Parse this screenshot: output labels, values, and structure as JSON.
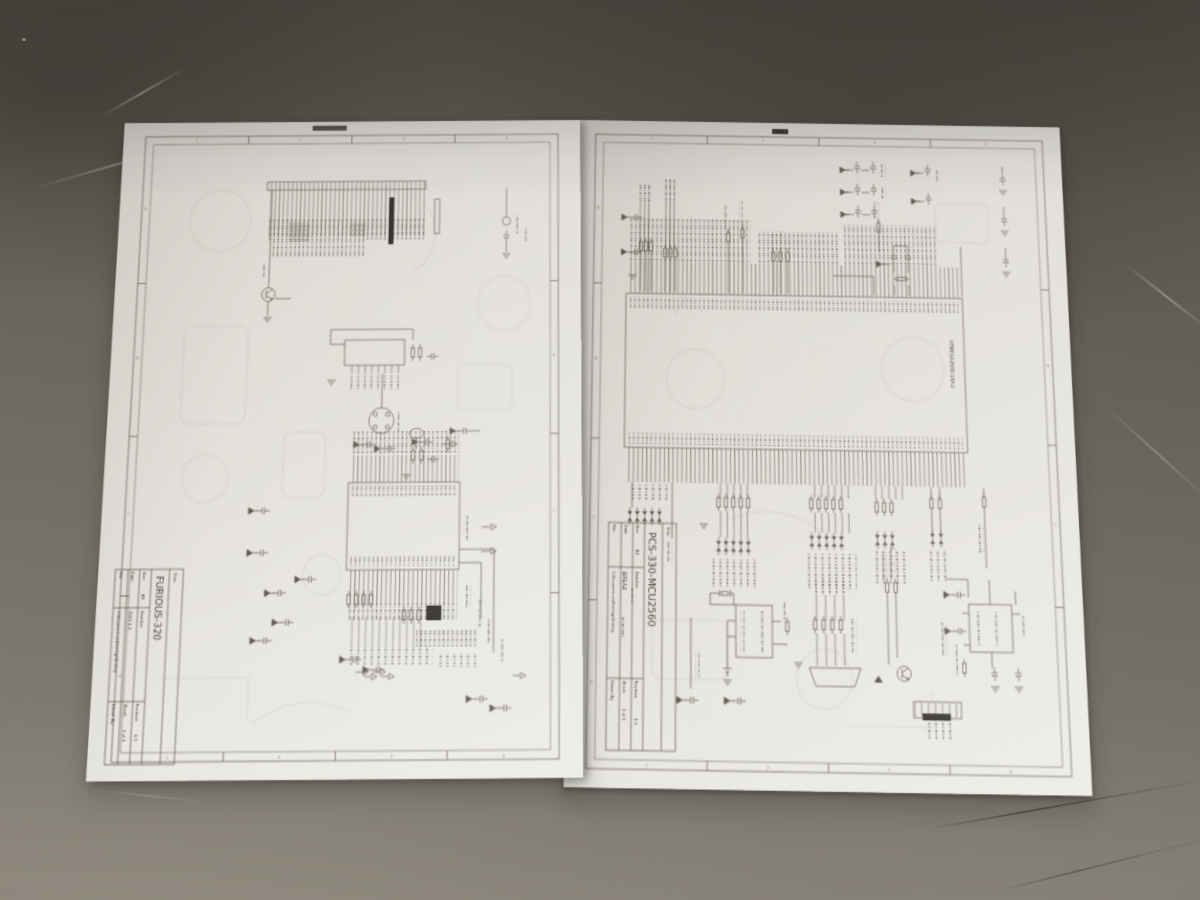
{
  "scene": {
    "floor_color": "#6b675e",
    "paper_color": "#e2dfd9",
    "ink_color": "#5d574e"
  },
  "frame_refs": {
    "cols": [
      "1",
      "2",
      "3",
      "4"
    ],
    "rows": [
      "A",
      "B",
      "C",
      "D"
    ]
  },
  "sheets": {
    "left": {
      "tb": {
        "title_label": "Title",
        "name": "FURIOUS-320",
        "size_label": "Size",
        "size": "A4",
        "number_label": "Number",
        "revision_label": "Revision",
        "revision": "1.0",
        "date_label": "Date",
        "date": "2010-1-1",
        "sheet_label": "Sheet:",
        "sheet": "1 of 1",
        "file_label": "File:",
        "file": "C:\\Documents and Settings\\Desktop",
        "drawn_label": "Drawn By:"
      }
    },
    "right": {
      "ic_label": "ATMEGA2560-16AU",
      "tb": {
        "title_label": "Title",
        "name": "PCS-330-MCU2560",
        "size_label": "Size",
        "size": "A4",
        "number_label": "Number",
        "revision_label": "Revision",
        "revision": "1.0",
        "date_label": "Date",
        "date": "2010-1-1",
        "sheet_label": "Sheet:",
        "sheet": "1 of 1",
        "file_label": "File:",
        "file": "C:\\Documents and Settings\\Desktop",
        "drawn_label": "Drawn By:"
      }
    }
  }
}
